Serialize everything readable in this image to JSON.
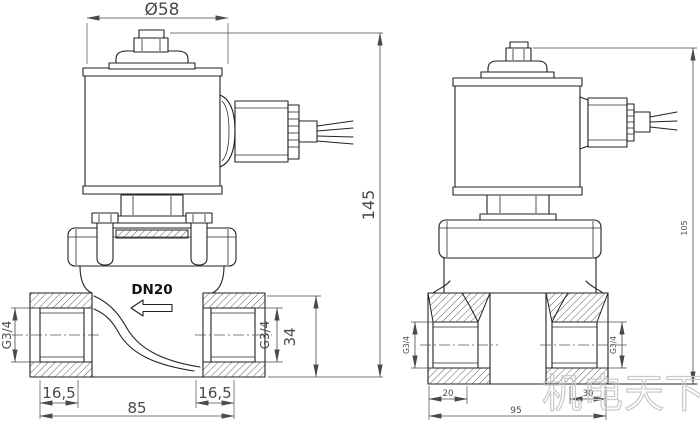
{
  "front_view": {
    "dim_diameter": "Ø58",
    "dim_height": "145",
    "thread_left": "G3/4",
    "thread_right": "G3/4",
    "dim_port_height": "34",
    "label_nominal": "DN20",
    "dim_offset_left": "16,5",
    "dim_offset_right": "16,5",
    "dim_width": "85"
  },
  "side_view": {
    "thread_left": "G3/4",
    "thread_right": "G3/4",
    "dim_offset_left": "20",
    "dim_offset_right": "30",
    "dim_width": "95",
    "dim_height": "105"
  },
  "watermark": "机电天下"
}
